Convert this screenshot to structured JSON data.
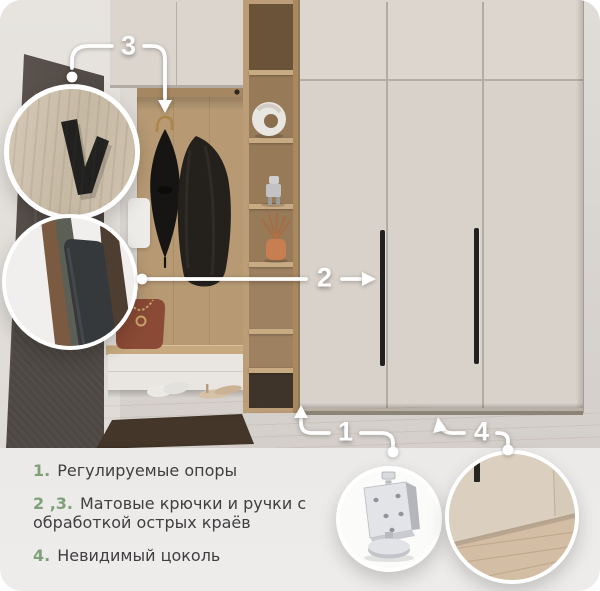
{
  "callouts": {
    "n1": "1",
    "n2": "2",
    "n3": "3",
    "n4": "4"
  },
  "legend": {
    "items": [
      {
        "num": "1.",
        "lines": [
          "Регулируемые опоры"
        ]
      },
      {
        "num": "2 ,3.",
        "lines": [
          "Матовые крючки и ручки с",
          "обработкой острых краёв"
        ]
      },
      {
        "num": "4.",
        "lines": [
          "Невидимый цоколь"
        ]
      }
    ]
  },
  "insets": {
    "c1": "matte-hook-closeup",
    "c2": "umbrella-stand-closeup",
    "c3": "adjustable-support-closeup",
    "c4": "invisible-plinth-closeup"
  },
  "colors": {
    "accent_green": "#7fa078",
    "legend_bg": "#edecea",
    "legend_text": "#3f3f41",
    "callout_white": "#ffffff"
  }
}
